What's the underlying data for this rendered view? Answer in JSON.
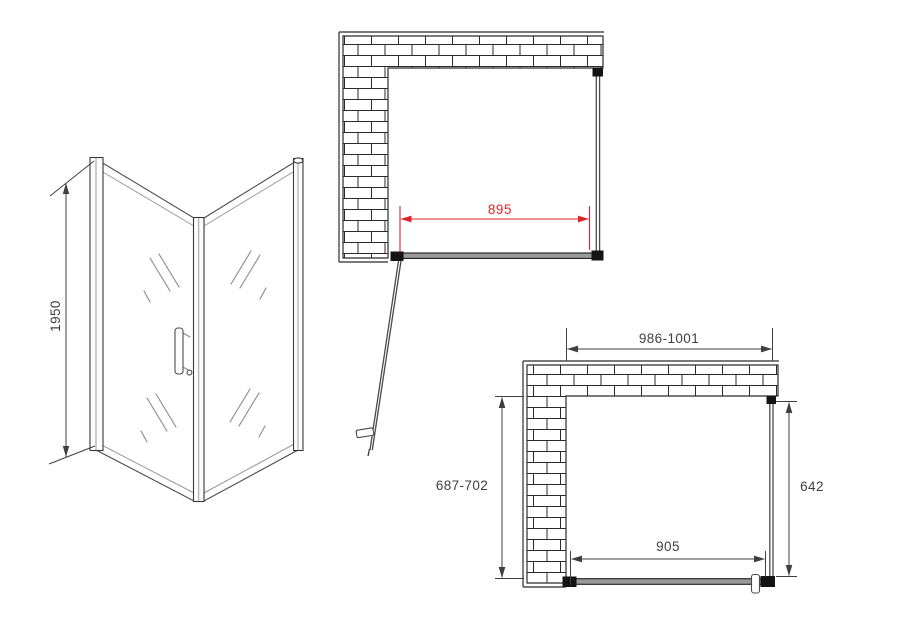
{
  "drawing": {
    "views": {
      "perspective": {
        "height": "1950"
      },
      "plan_open": {
        "glass_width": "895"
      },
      "plan_dimensioned": {
        "overall_width": "986-1001",
        "wall_opening_depth": "687-702",
        "side_panel_width": "642",
        "door_glass_width": "905"
      }
    },
    "colors": {
      "line": "#2b2b2b",
      "dim_text": "#3f3f3f",
      "accent_red": "#e02428",
      "background": "#ffffff"
    }
  }
}
